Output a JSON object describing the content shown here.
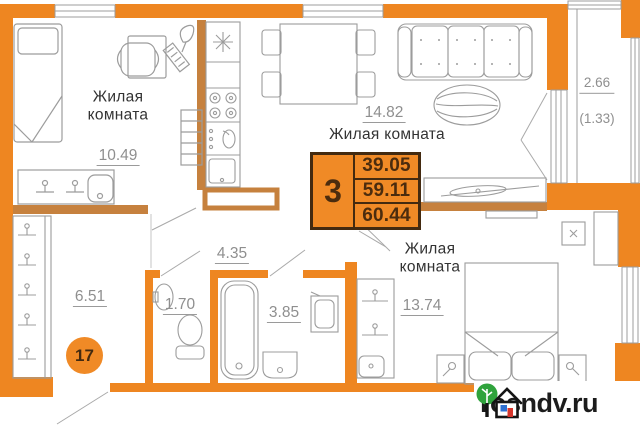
{
  "unit": {
    "number_on_floor": "17"
  },
  "summary": {
    "rooms_count": "3",
    "living_area": "39.05",
    "area_without_balcony": "59.11",
    "total_area": "60.44"
  },
  "rooms": {
    "bedroom_left": {
      "name": "Жилая\nкомната",
      "area": "10.49"
    },
    "kitchen_living": {
      "name": "Жилая комната",
      "area": "14.82"
    },
    "balcony": {
      "area": "2.66",
      "area_coefficient": "(1.33)"
    },
    "corridor": {
      "area": "4.35"
    },
    "hallway": {
      "area": "6.51"
    },
    "wc": {
      "area": "1.70"
    },
    "bathroom": {
      "area": "3.85"
    },
    "bedroom_right": {
      "name": "Жилая\nкомната",
      "area": "13.74"
    }
  },
  "watermark": {
    "site": "rosndv.ru"
  },
  "colors": {
    "bearing_wall": "#EE8621",
    "partition_wall": "#C6813E",
    "summary_box": "#F08A26",
    "summary_text": "#4b2c0e",
    "dimension_text": "#8f8f8f",
    "label_text": "#333333"
  }
}
